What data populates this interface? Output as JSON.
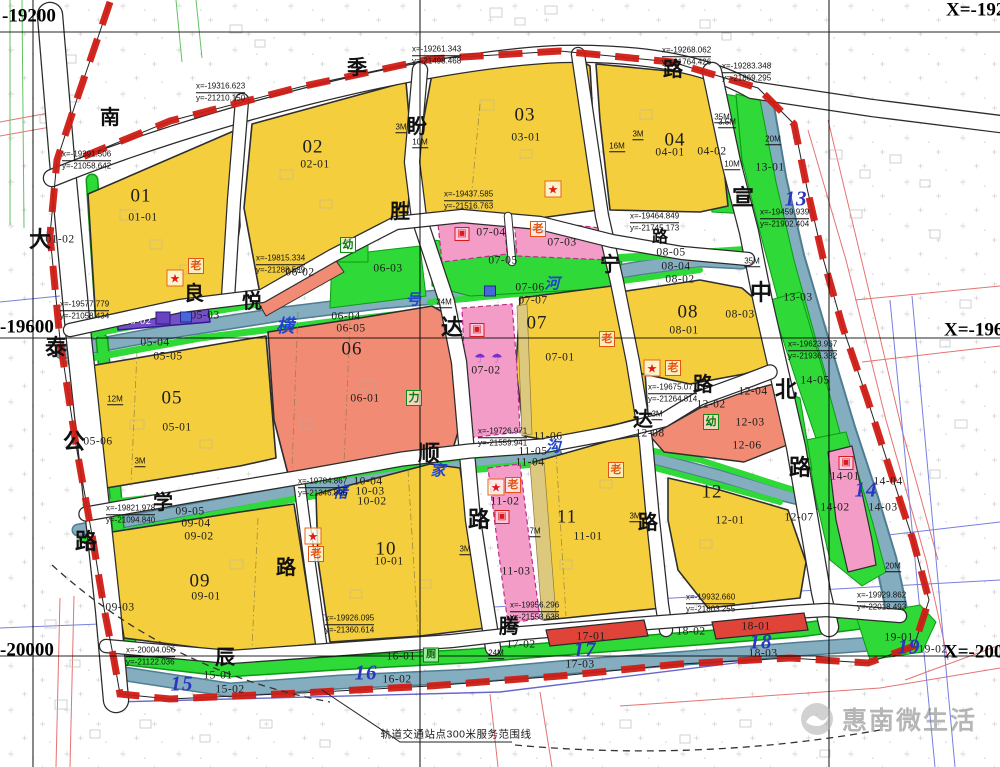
{
  "map": {
    "watermark": "惠南微生活",
    "service_note": "轨道交通站点300米服务范围线",
    "palette": {
      "residential_yellow": "#f5ce3e",
      "public_green": "#2fd937",
      "commercial_salmon": "#f28b74",
      "strong_red": "#e04338",
      "pink": "#f49cc8",
      "purple_strip": "#7450c8",
      "river_blue": "#84adc0",
      "boundary_red": "#cf1d15"
    },
    "grid_labels": [
      {
        "t": "-19200",
        "x": 2,
        "y": 16
      },
      {
        "t": "-19600",
        "x": 0,
        "y": 327
      },
      {
        "t": "-20000",
        "x": 0,
        "y": 650
      },
      {
        "t": "X=-19200",
        "x": 946,
        "y": 10
      },
      {
        "t": "X=-19600",
        "x": 944,
        "y": 330
      },
      {
        "t": "X=-20000",
        "x": 944,
        "y": 652
      }
    ],
    "block_labels": [
      {
        "t": "01",
        "x": 141,
        "y": 196,
        "k": "major"
      },
      {
        "t": "02",
        "x": 313,
        "y": 147,
        "k": "major"
      },
      {
        "t": "03",
        "x": 525,
        "y": 115,
        "k": "major"
      },
      {
        "t": "04",
        "x": 675,
        "y": 140,
        "k": "major"
      },
      {
        "t": "05",
        "x": 172,
        "y": 398,
        "k": "major"
      },
      {
        "t": "06",
        "x": 352,
        "y": 349,
        "k": "major"
      },
      {
        "t": "07",
        "x": 537,
        "y": 323,
        "k": "major"
      },
      {
        "t": "08",
        "x": 688,
        "y": 312,
        "k": "major"
      },
      {
        "t": "09",
        "x": 200,
        "y": 581,
        "k": "major"
      },
      {
        "t": "10",
        "x": 386,
        "y": 549,
        "k": "major"
      },
      {
        "t": "11",
        "x": 567,
        "y": 517,
        "k": "major"
      },
      {
        "t": "12",
        "x": 712,
        "y": 492,
        "k": "major"
      },
      {
        "t": "13",
        "x": 796,
        "y": 199,
        "k": "major-blue"
      },
      {
        "t": "14",
        "x": 866,
        "y": 490,
        "k": "major-blue"
      },
      {
        "t": "15",
        "x": 182,
        "y": 684,
        "k": "major-blue"
      },
      {
        "t": "16",
        "x": 366,
        "y": 673,
        "k": "major-blue"
      },
      {
        "t": "17",
        "x": 585,
        "y": 650,
        "k": "major-blue"
      },
      {
        "t": "18",
        "x": 761,
        "y": 642,
        "k": "major-blue"
      },
      {
        "t": "19",
        "x": 909,
        "y": 647,
        "k": "major-blue"
      },
      {
        "t": "01-01",
        "x": 143,
        "y": 218
      },
      {
        "t": "01-02",
        "x": 60,
        "y": 240
      },
      {
        "t": "02-01",
        "x": 315,
        "y": 165
      },
      {
        "t": "03-01",
        "x": 526,
        "y": 138
      },
      {
        "t": "04-01",
        "x": 670,
        "y": 153
      },
      {
        "t": "04-02",
        "x": 712,
        "y": 152
      },
      {
        "t": "05-01",
        "x": 177,
        "y": 428
      },
      {
        "t": "05-02",
        "x": 138,
        "y": 322,
        "k": "sub-white"
      },
      {
        "t": "05-03",
        "x": 205,
        "y": 316
      },
      {
        "t": "05-04",
        "x": 155,
        "y": 343
      },
      {
        "t": "05-05",
        "x": 168,
        "y": 357
      },
      {
        "t": "05-06",
        "x": 98,
        "y": 442
      },
      {
        "t": "06-01",
        "x": 365,
        "y": 399
      },
      {
        "t": "06-02",
        "x": 300,
        "y": 273
      },
      {
        "t": "06-03",
        "x": 388,
        "y": 269
      },
      {
        "t": "06-04",
        "x": 346,
        "y": 317
      },
      {
        "t": "06-05",
        "x": 351,
        "y": 329
      },
      {
        "t": "07-01",
        "x": 560,
        "y": 358
      },
      {
        "t": "07-02",
        "x": 486,
        "y": 371
      },
      {
        "t": "07-03",
        "x": 562,
        "y": 243
      },
      {
        "t": "07-04",
        "x": 491,
        "y": 233
      },
      {
        "t": "07-05",
        "x": 503,
        "y": 261
      },
      {
        "t": "07-06",
        "x": 530,
        "y": 288
      },
      {
        "t": "07-07",
        "x": 533,
        "y": 301
      },
      {
        "t": "08-01",
        "x": 684,
        "y": 331
      },
      {
        "t": "08-02",
        "x": 680,
        "y": 280
      },
      {
        "t": "08-03",
        "x": 740,
        "y": 315
      },
      {
        "t": "08-04",
        "x": 676,
        "y": 267
      },
      {
        "t": "08-05",
        "x": 671,
        "y": 253
      },
      {
        "t": "09-01",
        "x": 206,
        "y": 597
      },
      {
        "t": "09-02",
        "x": 199,
        "y": 537
      },
      {
        "t": "09-03",
        "x": 120,
        "y": 608
      },
      {
        "t": "09-04",
        "x": 196,
        "y": 524
      },
      {
        "t": "09-05",
        "x": 190,
        "y": 512
      },
      {
        "t": "10-01",
        "x": 389,
        "y": 562
      },
      {
        "t": "10-02",
        "x": 372,
        "y": 502
      },
      {
        "t": "10-03",
        "x": 370,
        "y": 492
      },
      {
        "t": "10-04",
        "x": 368,
        "y": 482
      },
      {
        "t": "11-01",
        "x": 588,
        "y": 537
      },
      {
        "t": "11-02",
        "x": 505,
        "y": 502
      },
      {
        "t": "11-03",
        "x": 516,
        "y": 572
      },
      {
        "t": "11-04",
        "x": 530,
        "y": 463
      },
      {
        "t": "11-05",
        "x": 533,
        "y": 452
      },
      {
        "t": "11-06",
        "x": 548,
        "y": 437
      },
      {
        "t": "12-01",
        "x": 730,
        "y": 521
      },
      {
        "t": "12-02",
        "x": 711,
        "y": 405
      },
      {
        "t": "12-03",
        "x": 750,
        "y": 423
      },
      {
        "t": "12-04",
        "x": 753,
        "y": 392
      },
      {
        "t": "12-06",
        "x": 747,
        "y": 446
      },
      {
        "t": "12-07",
        "x": 799,
        "y": 518
      },
      {
        "t": "12-08",
        "x": 650,
        "y": 434
      },
      {
        "t": "13-01",
        "x": 770,
        "y": 168
      },
      {
        "t": "13-03",
        "x": 798,
        "y": 298
      },
      {
        "t": "14-01",
        "x": 845,
        "y": 477
      },
      {
        "t": "14-02",
        "x": 835,
        "y": 508
      },
      {
        "t": "14-03",
        "x": 883,
        "y": 508
      },
      {
        "t": "14-04",
        "x": 888,
        "y": 482
      },
      {
        "t": "14-05",
        "x": 815,
        "y": 381
      },
      {
        "t": "15-01",
        "x": 218,
        "y": 676
      },
      {
        "t": "15-02",
        "x": 230,
        "y": 690
      },
      {
        "t": "16-01",
        "x": 401,
        "y": 657
      },
      {
        "t": "16-02",
        "x": 397,
        "y": 680
      },
      {
        "t": "17-01",
        "x": 591,
        "y": 637
      },
      {
        "t": "17-02",
        "x": 521,
        "y": 645
      },
      {
        "t": "17-03",
        "x": 580,
        "y": 665
      },
      {
        "t": "18-01",
        "x": 756,
        "y": 627
      },
      {
        "t": "18-02",
        "x": 691,
        "y": 632
      },
      {
        "t": "18-03",
        "x": 763,
        "y": 654
      },
      {
        "t": "19-01",
        "x": 899,
        "y": 638
      },
      {
        "t": "19-02",
        "x": 933,
        "y": 650
      }
    ],
    "road_name_chars": [
      {
        "t": "南",
        "x": 110,
        "y": 118
      },
      {
        "t": "季",
        "x": 357,
        "y": 68
      },
      {
        "t": "路",
        "x": 673,
        "y": 70
      },
      {
        "t": "大",
        "x": 40,
        "y": 240,
        "fs": 22
      },
      {
        "t": "泰",
        "x": 56,
        "y": 348,
        "fs": 22
      },
      {
        "t": "公",
        "x": 74,
        "y": 442,
        "fs": 22
      },
      {
        "t": "路",
        "x": 86,
        "y": 542,
        "fs": 22
      },
      {
        "t": "盼",
        "x": 417,
        "y": 127
      },
      {
        "t": "胜",
        "x": 400,
        "y": 212
      },
      {
        "t": "良",
        "x": 194,
        "y": 294
      },
      {
        "t": "悦",
        "x": 252,
        "y": 302
      },
      {
        "t": "达",
        "x": 452,
        "y": 328,
        "fs": 22
      },
      {
        "t": "顺",
        "x": 429,
        "y": 454,
        "fs": 22
      },
      {
        "t": "路",
        "x": 479,
        "y": 520,
        "fs": 22
      },
      {
        "t": "宁",
        "x": 610,
        "y": 265
      },
      {
        "t": "路",
        "x": 648,
        "y": 523
      },
      {
        "t": "宣",
        "x": 743,
        "y": 198,
        "fs": 22
      },
      {
        "t": "中",
        "x": 761,
        "y": 293,
        "fs": 22
      },
      {
        "t": "北",
        "x": 786,
        "y": 390,
        "fs": 22
      },
      {
        "t": "路",
        "x": 800,
        "y": 468,
        "fs": 22
      },
      {
        "t": "达",
        "x": 643,
        "y": 420
      },
      {
        "t": "路",
        "x": 703,
        "y": 385
      },
      {
        "t": "路",
        "x": 660,
        "y": 238,
        "fs": 16
      },
      {
        "t": "学",
        "x": 163,
        "y": 503
      },
      {
        "t": "路",
        "x": 286,
        "y": 568
      },
      {
        "t": "辰",
        "x": 225,
        "y": 658
      },
      {
        "t": "腾",
        "x": 509,
        "y": 627
      }
    ],
    "river_name_chars": [
      {
        "t": "横",
        "x": 285,
        "y": 326,
        "fs": 18
      },
      {
        "t": "号",
        "x": 413,
        "y": 301
      },
      {
        "t": "河",
        "x": 552,
        "y": 285
      },
      {
        "t": "褚",
        "x": 340,
        "y": 494
      },
      {
        "t": "家",
        "x": 438,
        "y": 472
      },
      {
        "t": "沟",
        "x": 553,
        "y": 448
      }
    ],
    "coordinate_notes": [
      {
        "l1": "x=-19316.623",
        "l2": "y=-21210.150",
        "x": 196,
        "y": 92
      },
      {
        "l1": "x=-19391.506",
        "l2": "y=-21058.642",
        "x": 62,
        "y": 160
      },
      {
        "l1": "x=-19577.779",
        "l2": "y=-21058.434",
        "x": 60,
        "y": 310
      },
      {
        "l1": "x=-19261.343",
        "l2": "y=-21498.468",
        "x": 412,
        "y": 55
      },
      {
        "l1": "x=-19268.062",
        "l2": "y=-21764.426",
        "x": 662,
        "y": 56
      },
      {
        "l1": "x=-19283.348",
        "l2": "y=-21869.295",
        "x": 722,
        "y": 72
      },
      {
        "l1": "x=-19437.585",
        "l2": "y=-21516.763",
        "x": 444,
        "y": 200
      },
      {
        "l1": "x=-19464.849",
        "l2": "y=-21745.173",
        "x": 630,
        "y": 222
      },
      {
        "l1": "x=-19459.939",
        "l2": "y=-21902.404",
        "x": 760,
        "y": 218
      },
      {
        "l1": "x=-19815.334",
        "l2": "y=-21288.589",
        "x": 256,
        "y": 264
      },
      {
        "l1": "x=-19623.967",
        "l2": "y=-21936.382",
        "x": 788,
        "y": 350
      },
      {
        "l1": "x=-19675.077",
        "l2": "y=-21264.814",
        "x": 648,
        "y": 393
      },
      {
        "l1": "x=-19726.971",
        "l2": "y=-21559.941",
        "x": 478,
        "y": 437
      },
      {
        "l1": "x=-19784.867",
        "l2": "y=-21346.896",
        "x": 298,
        "y": 487
      },
      {
        "l1": "x=-19821.978",
        "l2": "y=-21094.840",
        "x": 106,
        "y": 514
      },
      {
        "l1": "x=-20004.056",
        "l2": "y=-21122.036",
        "x": 126,
        "y": 656
      },
      {
        "l1": "x=-19926.095",
        "l2": "y=-21360.614",
        "x": 325,
        "y": 624
      },
      {
        "l1": "x=-19956.296",
        "l2": "y=-21553.638",
        "x": 510,
        "y": 611
      },
      {
        "l1": "x=-19932.660",
        "l2": "y=-21803.255",
        "x": 686,
        "y": 603
      },
      {
        "l1": "x=-19929.862",
        "l2": "y=-22018.493",
        "x": 857,
        "y": 601
      }
    ],
    "dimension_notes": [
      {
        "t": "3M",
        "x": 401,
        "y": 128
      },
      {
        "t": "10M",
        "x": 420,
        "y": 143
      },
      {
        "t": "16M",
        "x": 617,
        "y": 147
      },
      {
        "t": "3.5M",
        "x": 727,
        "y": 123
      },
      {
        "t": "10M",
        "x": 732,
        "y": 165
      },
      {
        "t": "20M",
        "x": 773,
        "y": 140
      },
      {
        "t": "35M",
        "x": 752,
        "y": 262
      },
      {
        "t": "3M",
        "x": 638,
        "y": 135
      },
      {
        "t": "24M",
        "x": 444,
        "y": 303
      },
      {
        "t": "12M",
        "x": 115,
        "y": 400
      },
      {
        "t": "3M",
        "x": 657,
        "y": 415
      },
      {
        "t": "7M",
        "x": 535,
        "y": 532
      },
      {
        "t": "3M",
        "x": 635,
        "y": 517
      },
      {
        "t": "3M",
        "x": 465,
        "y": 550
      },
      {
        "t": "24M",
        "x": 496,
        "y": 654
      },
      {
        "t": "20M",
        "x": 893,
        "y": 567
      },
      {
        "t": "3M",
        "x": 140,
        "y": 462
      },
      {
        "t": "35M",
        "x": 722,
        "y": 118
      }
    ],
    "facility_icons": [
      {
        "name": "star-landmark-icon",
        "style": "star",
        "glyph": "★",
        "x": 175,
        "y": 278
      },
      {
        "name": "star-landmark-icon",
        "style": "star",
        "glyph": "★",
        "x": 553,
        "y": 189
      },
      {
        "name": "star-landmark-icon",
        "style": "star",
        "glyph": "★",
        "x": 652,
        "y": 368
      },
      {
        "name": "star-landmark-icon",
        "style": "star",
        "glyph": "★",
        "x": 496,
        "y": 487
      },
      {
        "name": "star-landmark-icon",
        "style": "star",
        "glyph": "★",
        "x": 313,
        "y": 536
      },
      {
        "name": "elder-care-icon",
        "style": "elder",
        "glyph": "老",
        "x": 196,
        "y": 266
      },
      {
        "name": "elder-care-icon",
        "style": "elder",
        "glyph": "老",
        "x": 538,
        "y": 229
      },
      {
        "name": "elder-care-icon",
        "style": "elder",
        "glyph": "老",
        "x": 673,
        "y": 368
      },
      {
        "name": "elder-care-icon",
        "style": "elder",
        "glyph": "老",
        "x": 513,
        "y": 485
      },
      {
        "name": "elder-care-icon",
        "style": "elder",
        "glyph": "老",
        "x": 316,
        "y": 554
      },
      {
        "name": "elder-care-icon",
        "style": "elder",
        "glyph": "老",
        "x": 616,
        "y": 470
      },
      {
        "name": "elder-care-icon",
        "style": "elder",
        "glyph": "老",
        "x": 607,
        "y": 339
      },
      {
        "name": "kindergarten-icon",
        "style": "kind",
        "glyph": "幼",
        "x": 348,
        "y": 245
      },
      {
        "name": "kindergarten-icon",
        "style": "kind",
        "glyph": "幼",
        "x": 711,
        "y": 422
      },
      {
        "name": "li-facility-icon",
        "style": "kind",
        "glyph": "力",
        "x": 414,
        "y": 398
      },
      {
        "name": "public-toilet-icon",
        "style": "toilet",
        "glyph": "厕",
        "x": 431,
        "y": 655
      },
      {
        "name": "facility-box-icon",
        "style": "redbox",
        "glyph": "▣",
        "x": 462,
        "y": 234
      },
      {
        "name": "facility-box-icon",
        "style": "redbox",
        "glyph": "▣",
        "x": 502,
        "y": 517
      },
      {
        "name": "facility-box-icon",
        "style": "redbox",
        "glyph": "▣",
        "x": 846,
        "y": 463
      },
      {
        "name": "facility-box-icon",
        "style": "redbox",
        "glyph": "▣",
        "x": 477,
        "y": 330
      },
      {
        "name": "dome-icon",
        "style": "dome",
        "glyph": "☂",
        "x": 480,
        "y": 358
      },
      {
        "name": "dome-icon",
        "style": "dome",
        "glyph": "☂",
        "x": 497,
        "y": 358
      },
      {
        "name": "substation-icon",
        "style": "purplebox",
        "glyph": "",
        "x": 163,
        "y": 318
      },
      {
        "name": "utility-box-icon",
        "style": "bluebox",
        "glyph": "",
        "x": 186,
        "y": 317
      },
      {
        "name": "utility-box-icon",
        "style": "bluebox",
        "glyph": "",
        "x": 490,
        "y": 291
      }
    ]
  }
}
